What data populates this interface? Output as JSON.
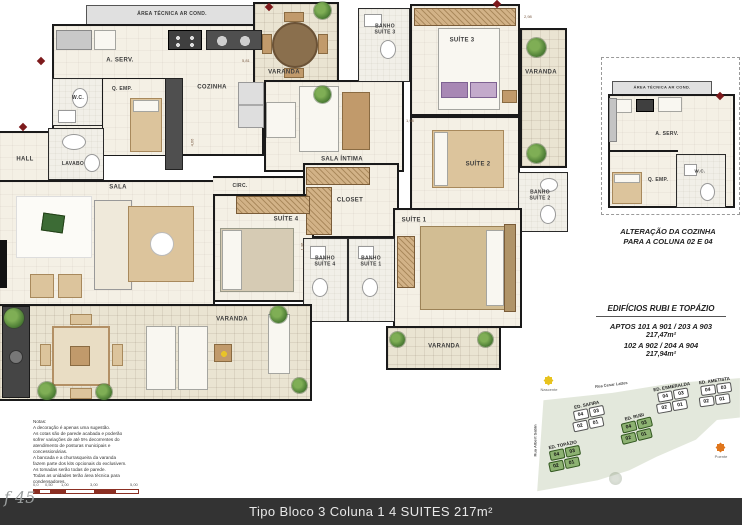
{
  "plan": {
    "rooms": {
      "area_tecnica": "ÁREA TÉCNICA AR COND.",
      "a_serv": "A. SERV.",
      "wc": "W.C.",
      "q_emp": "Q. EMP.",
      "cozinha": "COZINHA",
      "hall": "HALL",
      "lavabo": "LAVABO",
      "sala": "SALA",
      "circ": "CIRC.",
      "varanda": "VARANDA",
      "sala_intima": "SALA ÍNTIMA",
      "banho_suite3": "BANHO\nSUÍTE 3",
      "suite3": "SUÍTE 3",
      "suite2": "SUÍTE 2",
      "banho_suite2": "BANHO\nSUÍTE 2",
      "closet": "CLOSET",
      "suite4": "SUÍTE 4",
      "suite1": "SUÍTE 1",
      "banho_suite4": "BANHO\nSUÍTE 4",
      "banho_suite1": "BANHO\nSUÍTE 1"
    },
    "dims": [
      "5,81",
      "2,98",
      "4,66",
      "1,36",
      "1,98"
    ]
  },
  "detail": {
    "rooms": {
      "area_tecnica": "ÁREA TÉCNICA AR COND.",
      "a_serv": "A. SERV.",
      "wc": "W.C.",
      "q_emp": "Q. EMP."
    },
    "caption_line1": "ALTERAÇÃO DA COZINHA",
    "caption_line2": "PARA A COLUNA 02 E 04"
  },
  "info": {
    "title": "EDIFÍCIOS RUBI E TOPÁZIO",
    "line1": "APTOS  101 A 901 / 203 A 903",
    "line2": "217,47m²",
    "line3": "102 A 902 / 204 A 904",
    "line4": "217,94m²"
  },
  "site_map": {
    "street_top": "Rua Cesar Lattes",
    "street_left": "Rua Albert Sabin",
    "sun_east": "Nascente",
    "sun_west": "Poente",
    "buildings": [
      {
        "name": "ED. SAFIRA",
        "units": [
          "04",
          "03",
          "02",
          "01"
        ],
        "highlighted": false
      },
      {
        "name": "ED. ESMERALDA",
        "units": [
          "04",
          "03",
          "02",
          "01"
        ],
        "highlighted": false
      },
      {
        "name": "ED. AMETISTA",
        "units": [
          "04",
          "03",
          "02",
          "01"
        ],
        "highlighted": false
      },
      {
        "name": "ED. RUBI",
        "units": [
          "04",
          "03",
          "02",
          "01"
        ],
        "highlighted": true
      },
      {
        "name": "ED. TOPÁZIO",
        "units": [
          "04",
          "03",
          "02",
          "01"
        ],
        "highlighted": true
      }
    ]
  },
  "notes": "Notas:\nA decoração é apenas uma sugestão.\nAs cotas são de parede acabada e poderão\nsofrer variações de até 5% decorrentes do\natendimento de posturas municipais e\nconcessionárias.\nA bancada e a churrasqueira da varanda\nfazem parte dos kits opcionais do exclusivem.\nAs tomadas serão todas de parede.\nTodas as unidades terão área técnica para\ncondensadores.",
  "scale": {
    "ticks": [
      "0,0",
      "0,50",
      "1,00",
      "3,00",
      "5,00"
    ]
  },
  "footer": {
    "title": "Tipo Bloco 3 Coluna 1 4 SUITES 217m²",
    "page_ref": "f 45"
  },
  "colors": {
    "wall": "#1a1a1a",
    "floor": "#f4f0e5",
    "varanda_floor": "#eae4d2",
    "highlight_green": "#8db272",
    "site_bg": "#e3e8dc",
    "accent_red": "#7d1a1c",
    "footer_bg": "#333333"
  }
}
